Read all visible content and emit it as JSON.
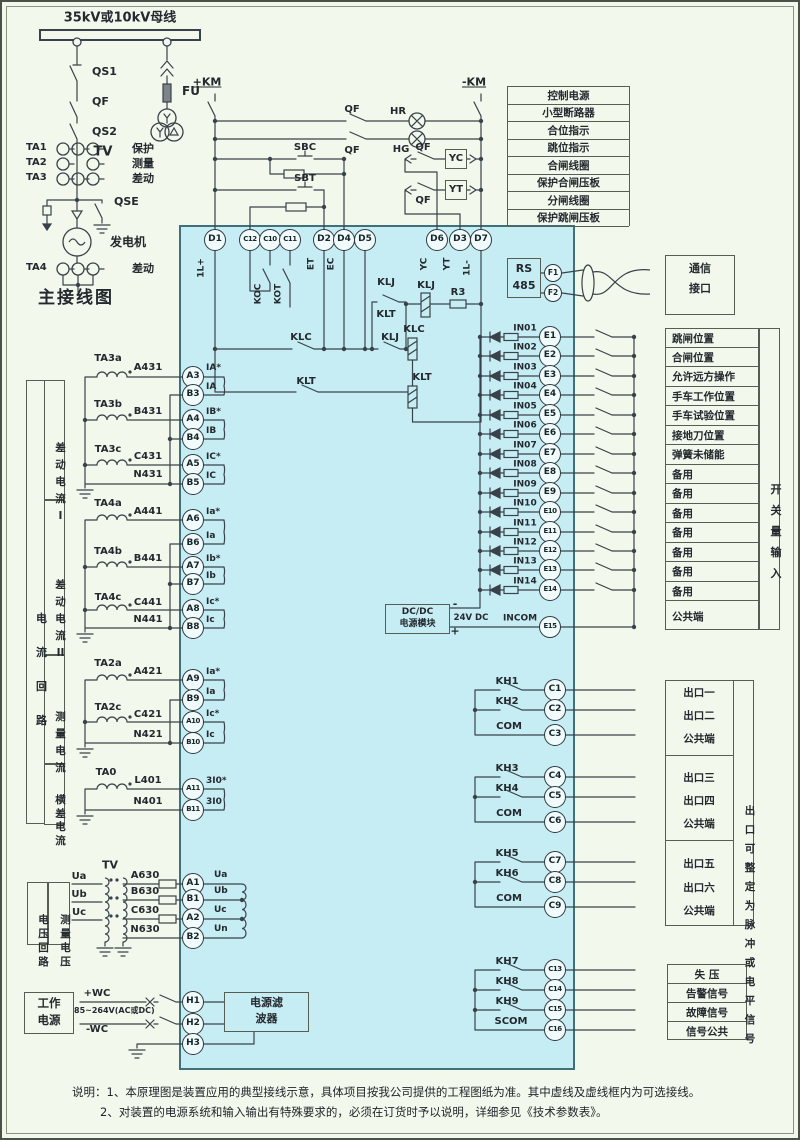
{
  "main_diagram": {
    "title": "主接线图",
    "busbar_label": "35kV或10kV母线",
    "qs1": "QS1",
    "qf": "QF",
    "qs2": "QS2",
    "qse": "QSE",
    "fu": "FU",
    "tv": "TV",
    "generator": "发电机",
    "ct_rows": [
      {
        "name": "TA1",
        "use": "保护"
      },
      {
        "name": "TA2",
        "use": "测量"
      },
      {
        "name": "TA3",
        "use": "差动"
      }
    ],
    "ta4": {
      "name": "TA4",
      "use": "差动"
    }
  },
  "control": {
    "km_plus": "+KM",
    "km_minus": "-KM",
    "qf_row1": "QF",
    "hr": "HR",
    "qf_row2": "QF",
    "hg": "HG",
    "sbc": "SBC",
    "sbt": "SBT",
    "qf_yc": "QF",
    "yc": "YC",
    "qf_yt": "QF",
    "yt": "YT",
    "legend": [
      "控制电源",
      "小型断路器",
      "合位指示",
      "跳位指示",
      "合闸线圈",
      "保护合闸压板",
      "分闸线圈",
      "保护跳闸压板"
    ]
  },
  "device": {
    "top_terminals": [
      {
        "id": "D1",
        "tag": "1L+"
      },
      {
        "id": "C12",
        "tag": ""
      },
      {
        "id": "C10",
        "tag": "KOC"
      },
      {
        "id": "C11",
        "tag": "KOT"
      },
      {
        "id": "D2",
        "tag": "ET"
      },
      {
        "id": "D4",
        "tag": "EC"
      },
      {
        "id": "D5",
        "tag": ""
      },
      {
        "id": "D6",
        "tag": "YC"
      },
      {
        "id": "D3",
        "tag": "YT"
      },
      {
        "id": "D7",
        "tag": "1L-"
      }
    ],
    "logic": {
      "klj_top": "KLJ",
      "klt_mid": "KLT",
      "klj_rail": "KLJ",
      "klj_coil": "KLJ",
      "r3": "R3",
      "klc_coil": "KLC",
      "klc_switch": "KLC",
      "klt_switch": "KLT",
      "klt_coil": "KLT"
    },
    "rs485": {
      "l1": "RS",
      "l2": "485",
      "f1": "F1",
      "f2": "F2"
    }
  },
  "comm": {
    "l1": "通信",
    "l2": "接口"
  },
  "inputs": {
    "rows": [
      {
        "sig": "IN01",
        "term": "E1",
        "label": "跳闸位置"
      },
      {
        "sig": "IN02",
        "term": "E2",
        "label": "合闸位置"
      },
      {
        "sig": "IN03",
        "term": "E3",
        "label": "允许远方操作"
      },
      {
        "sig": "IN04",
        "term": "E4",
        "label": "手车工作位置"
      },
      {
        "sig": "IN05",
        "term": "E5",
        "label": "手车试验位置"
      },
      {
        "sig": "IN06",
        "term": "E6",
        "label": "接地刀位置"
      },
      {
        "sig": "IN07",
        "term": "E7",
        "label": "弹簧未储能"
      },
      {
        "sig": "IN08",
        "term": "E8",
        "label": "备用"
      },
      {
        "sig": "IN09",
        "term": "E9",
        "label": "备用"
      },
      {
        "sig": "IN10",
        "term": "E10",
        "label": "备用"
      },
      {
        "sig": "IN11",
        "term": "E11",
        "label": "备用"
      },
      {
        "sig": "IN12",
        "term": "E12",
        "label": "备用"
      },
      {
        "sig": "IN13",
        "term": "E13",
        "label": "备用"
      },
      {
        "sig": "IN14",
        "term": "E14",
        "label": "备用"
      }
    ],
    "common": {
      "sig": "INCOM",
      "term": "E15",
      "label": "公共端"
    },
    "group_label": "开关量输入"
  },
  "dcdc": {
    "l1": "DC/DC",
    "l2": "电源模块",
    "minus": "-",
    "plus": "+",
    "volt": "24V DC"
  },
  "outputs": {
    "g1": {
      "k1": "KH1",
      "t1": "C1",
      "k2": "KH2",
      "t2": "C2",
      "com": "COM",
      "t3": "C3",
      "labels": [
        "出口一",
        "出口二",
        "公共端"
      ]
    },
    "g2": {
      "k1": "KH3",
      "t1": "C4",
      "k2": "KH4",
      "t2": "C5",
      "com": "COM",
      "t3": "C6",
      "labels": [
        "出口三",
        "出口四",
        "公共端"
      ]
    },
    "g3": {
      "k1": "KH5",
      "t1": "C7",
      "k2": "KH6",
      "t2": "C8",
      "com": "COM",
      "t3": "C9",
      "labels": [
        "出口五",
        "出口六",
        "公共端"
      ]
    },
    "g4": {
      "k1": "KH7",
      "t1": "C13",
      "k2": "KH8",
      "t2": "C14",
      "k3": "KH9",
      "t3": "C15",
      "com": "SCOM",
      "t4": "C16",
      "labels": [
        "失  压",
        "告警信号",
        "故障信号",
        "信号公共"
      ]
    },
    "side_label": "出口可整定为脉冲或电平信号"
  },
  "current": {
    "outer_label": "电流回路",
    "s1": {
      "label": "差动电流I",
      "ta1": "TA3a",
      "w1": "A431",
      "t1": "A3",
      "sig1": "IA*",
      "t2": "B3",
      "sig2": "IA",
      "ta2": "TA3b",
      "w2": "B431",
      "t3": "A4",
      "sig3": "IB*",
      "t4": "B4",
      "sig4": "IB",
      "ta3": "TA3c",
      "w3": "C431",
      "t5": "A5",
      "sig5": "IC*",
      "w4": "N431",
      "t6": "B5",
      "sig6": "IC"
    },
    "s2": {
      "label": "差动电流II",
      "ta1": "TA4a",
      "w1": "A441",
      "t1": "A6",
      "sig1": "Ia*",
      "t2": "B6",
      "sig2": "Ia",
      "ta2": "TA4b",
      "w2": "B441",
      "t3": "A7",
      "sig3": "Ib*",
      "t4": "B7",
      "sig4": "Ib",
      "ta3": "TA4c",
      "w3": "C441",
      "t5": "A8",
      "sig5": "Ic*",
      "w4": "N441",
      "t6": "B8",
      "sig6": "Ic"
    },
    "s3": {
      "label": "测量电流",
      "ta1": "TA2a",
      "w1": "A421",
      "t1": "A9",
      "sig1": "Ia*",
      "t2": "B9",
      "sig2": "Ia",
      "ta2": "TA2c",
      "w2": "C421",
      "t3": "A10",
      "sig3": "Ic*",
      "w3": "N421",
      "t4": "B10",
      "sig4": "Ic"
    },
    "s4": {
      "label": "横差电流",
      "ta1": "TA0",
      "w1": "L401",
      "t1": "A11",
      "sig1": "3I0*",
      "w2": "N401",
      "t2": "B11",
      "sig2": "3I0"
    }
  },
  "voltage": {
    "box1": "电压回路",
    "box2": "测量电压",
    "tv": "TV",
    "ph1": "Ua",
    "ph2": "Ub",
    "ph3": "Uc",
    "w1": "A630",
    "w2": "B630",
    "w3": "C630",
    "w4": "N630",
    "t1": "A1",
    "t2": "B1",
    "t3": "A2",
    "t4": "B2",
    "sig1": "Ua",
    "sig2": "Ub",
    "sig3": "Uc",
    "sig4": "Un"
  },
  "power": {
    "box_l1": "工作",
    "box_l2": "电源",
    "plus": "+WC",
    "minus": "-WC",
    "range": "85~264V(AC或DC)",
    "t1": "H1",
    "t2": "H2",
    "t3": "H3",
    "filter_l1": "电源滤",
    "filter_l2": "波器"
  },
  "notes": {
    "line1": "说明：1、本原理图是装置应用的典型接线示意，具体项目按我公司提供的工程图纸为准。其中虚线及虚线框内为可选接线。",
    "line2": "2、对装置的电源系统和输入输出有特殊要求的，必须在订货时予以说明，详细参见《技术参数表》。"
  }
}
